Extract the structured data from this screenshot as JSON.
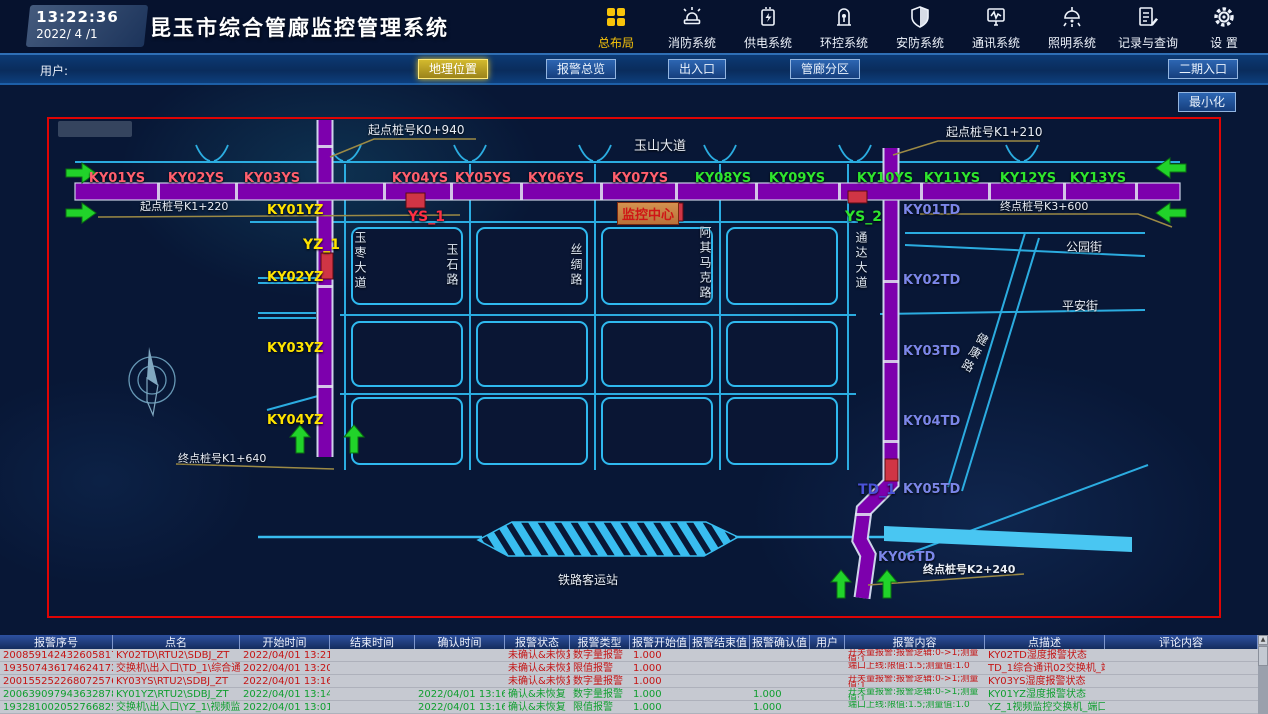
{
  "header": {
    "time": "13:22:36",
    "date": "2022/ 4 /1",
    "title": "昆玉市综合管廊监控管理系统",
    "accent_color": "#f7c30a",
    "nav_items": [
      {
        "label": "总布局",
        "icon": "grid-icon",
        "active": true
      },
      {
        "label": "消防系统",
        "icon": "fire-alarm-icon",
        "active": false
      },
      {
        "label": "供电系统",
        "icon": "power-supply-icon",
        "active": false
      },
      {
        "label": "环控系统",
        "icon": "env-control-icon",
        "active": false
      },
      {
        "label": "安防系统",
        "icon": "security-shield-icon",
        "active": false
      },
      {
        "label": "通讯系统",
        "icon": "comm-monitor-icon",
        "active": false
      },
      {
        "label": "照明系统",
        "icon": "lighting-lamp-icon",
        "active": false
      },
      {
        "label": "记录与查询",
        "icon": "records-icon",
        "active": false
      },
      {
        "label": "设 置",
        "icon": "settings-gear-icon",
        "active": false
      }
    ]
  },
  "toolbar": {
    "user_label": "用户:",
    "buttons": [
      {
        "label": "地理位置",
        "active": true
      },
      {
        "label": "报警总览",
        "active": false
      },
      {
        "label": "出入口",
        "active": false
      },
      {
        "label": "管廊分区",
        "active": false
      },
      {
        "label": "二期入口",
        "active": false
      }
    ],
    "minimize_label": "最小化"
  },
  "map": {
    "stake_labels": {
      "start_k0_940": "起点桩号K0+940",
      "start_k1_220": "起点桩号K1+220",
      "start_k1_210": "起点桩号K1+210",
      "end_k3_600": "终点桩号K3+600",
      "end_k1_640": "终点桩号K1+640",
      "end_k2_240": "终点桩号K2+240"
    },
    "road_labels": {
      "yushan": "玉山大道",
      "yuzao": "玉枣大道",
      "yushi": "玉石路",
      "sichou": "丝绸路",
      "aqimake": "阿其马克路",
      "tongda": "通达大道",
      "gongyuan": "公园街",
      "pingan": "平安街",
      "jiankang": "健康路",
      "railway_station": "铁路客运站"
    },
    "monitor_center_label": "监控中心",
    "ys_stations": [
      {
        "id": "KY01YS",
        "color": "#ff5f6e"
      },
      {
        "id": "KY02YS",
        "color": "#ff5f6e"
      },
      {
        "id": "KY03YS",
        "color": "#ff5f6e"
      },
      {
        "id": "KY04YS",
        "color": "#ff5f6e"
      },
      {
        "id": "KY05YS",
        "color": "#ff5f6e"
      },
      {
        "id": "KY06YS",
        "color": "#ff5f6e"
      },
      {
        "id": "KY07YS",
        "color": "#ff5f6e"
      },
      {
        "id": "KY08YS",
        "color": "#2ee52e"
      },
      {
        "id": "KY09YS",
        "color": "#2ee52e"
      },
      {
        "id": "KY10YS",
        "color": "#2ee52e"
      },
      {
        "id": "KY11YS",
        "color": "#2ee52e"
      },
      {
        "id": "KY12YS",
        "color": "#2ee52e"
      },
      {
        "id": "KY13YS",
        "color": "#2ee52e"
      }
    ],
    "yz_stations": [
      {
        "id": "KY01YZ",
        "color": "#ffe400"
      },
      {
        "id": "KY02YZ",
        "color": "#ffe400"
      },
      {
        "id": "KY03YZ",
        "color": "#ffe400"
      },
      {
        "id": "KY04YZ",
        "color": "#ffe400"
      }
    ],
    "td_stations": [
      {
        "id": "KY01TD",
        "color": "#7b86e8"
      },
      {
        "id": "KY02TD",
        "color": "#7b86e8"
      },
      {
        "id": "KY03TD",
        "color": "#7b86e8"
      },
      {
        "id": "KY04TD",
        "color": "#7b86e8"
      },
      {
        "id": "KY05TD",
        "color": "#7b86e8"
      },
      {
        "id": "KY06TD",
        "color": "#7b86e8"
      }
    ],
    "alarm_points": [
      {
        "id": "YS_1",
        "color": "#ff2f45"
      },
      {
        "id": "YS_2",
        "color": "#2ee52e"
      },
      {
        "id": "YZ_1",
        "color": "#ffe400"
      },
      {
        "id": "TD_1",
        "color": "#4a52d8"
      }
    ]
  },
  "alarm_table": {
    "columns": [
      "报警序号",
      "点名",
      "开始时间",
      "结束时间",
      "确认时间",
      "报警状态",
      "报警类型",
      "报警开始值",
      "报警结束值",
      "报警确认值",
      "用户",
      "报警内容",
      "点描述",
      "评论内容"
    ],
    "rows": [
      {
        "seq": "2008591424326058179",
        "point": "KY02TD\\RTU2\\SDBJ_ZT",
        "start": "2022/04/01 13:21:55",
        "end": "",
        "confirm": "",
        "state": "未确认&未恢复",
        "type": "数字量报警",
        "start_val": "1.000",
        "end_val": "",
        "confirm_val": "",
        "user": "",
        "content": "开关量报警:报警逻辑:0->1;测量值:1",
        "desc": "KY02TD湿度报警状态",
        "comment": "",
        "acknowledged": false
      },
      {
        "seq": "1935074361746241723",
        "point": "交换机\\出入口\\TD_1\\综合通讯02\\X02",
        "start": "2022/04/01 13:20:59",
        "end": "",
        "confirm": "",
        "state": "未确认&未恢复",
        "type": "限值报警",
        "start_val": "1.000",
        "end_val": "",
        "confirm_val": "",
        "user": "",
        "content": "端口上线:限值:1.5;测量值:1.0",
        "desc": "TD_1综合通讯02交换机_端口2",
        "comment": "",
        "acknowledged": false
      },
      {
        "seq": "2001552522680725761",
        "point": "KY03YS\\RTU2\\SDBJ_ZT",
        "start": "2022/04/01 13:16:49",
        "end": "",
        "confirm": "",
        "state": "未确认&未恢复",
        "type": "数字量报警",
        "start_val": "1.000",
        "end_val": "",
        "confirm_val": "",
        "user": "",
        "content": "开关量报警:报警逻辑:0->1;测量值:1",
        "desc": "KY03YS湿度报警状态",
        "comment": "",
        "acknowledged": false
      },
      {
        "seq": "2006390979436328781",
        "point": "KY01YZ\\RTU2\\SDBJ_ZT",
        "start": "2022/04/01 13:14:53",
        "end": "",
        "confirm": "2022/04/01 13:16:05",
        "state": "确认&未恢复",
        "type": "数字量报警",
        "start_val": "1.000",
        "end_val": "",
        "confirm_val": "1.000",
        "user": "",
        "content": "开关量报警:报警逻辑:0->1;测量值:1",
        "desc": "KY01YZ湿度报警状态",
        "comment": "",
        "acknowledged": true
      },
      {
        "seq": "1932810020527668253",
        "point": "交换机\\出入口\\YZ_1\\视频监控\\XK14",
        "start": "2022/04/01 13:01:17",
        "end": "",
        "confirm": "2022/04/01 13:16:05",
        "state": "确认&未恢复",
        "type": "限值报警",
        "start_val": "1.000",
        "end_val": "",
        "confirm_val": "1.000",
        "user": "",
        "content": "端口上线:限值:1.5;测量值:1.0",
        "desc": "YZ_1视频监控交换机_端口14",
        "comment": "",
        "acknowledged": true
      }
    ]
  }
}
